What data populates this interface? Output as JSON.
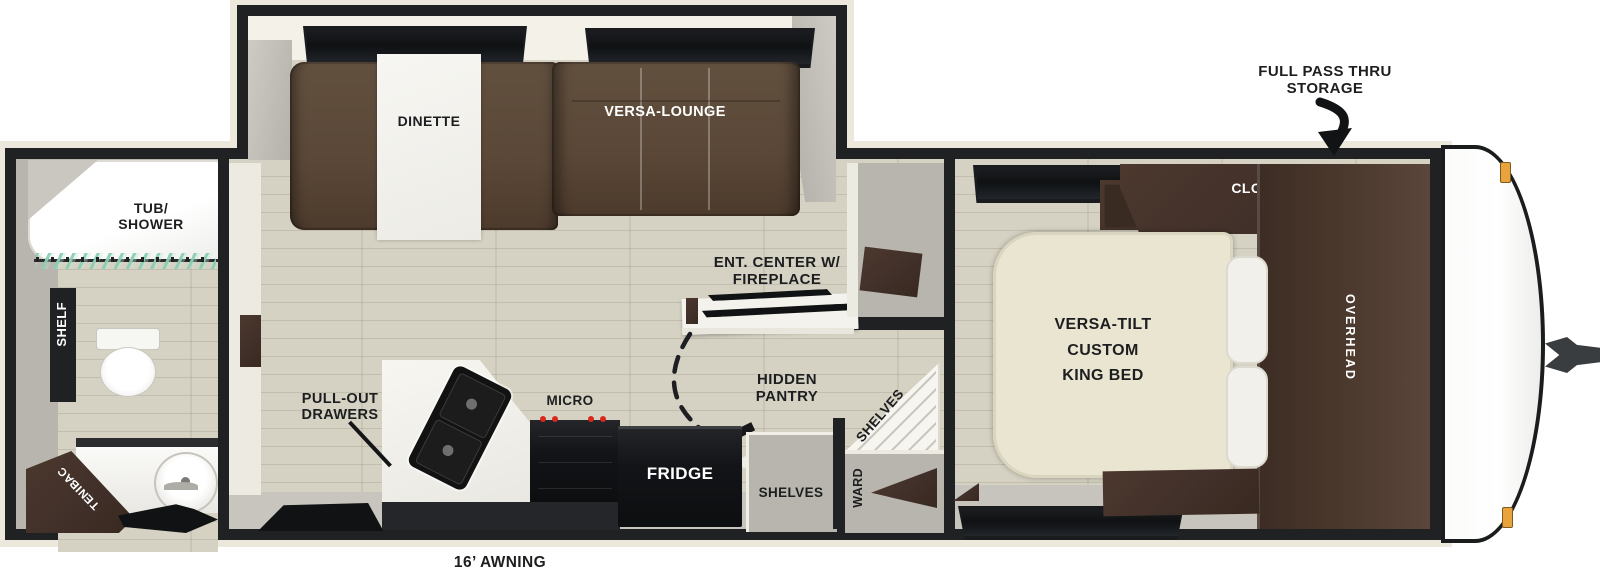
{
  "figure": "rv-travel-trailer-floor-plan",
  "labels": {
    "full_pass_thru_1": "FULL PASS THRU",
    "full_pass_thru_2": "STORAGE",
    "awning": "16’ AWNING",
    "tub_shower_1": "TUB/",
    "tub_shower_2": "SHOWER",
    "shelf": "SHELF",
    "cabinet": "CABINET",
    "dinette": "DINETTE",
    "versa_lounge": "VERSA-LOUNGE",
    "ent_center_1": "ENT. CENTER W/",
    "ent_center_2": "FIREPLACE",
    "hidden_pantry_1": "HIDDEN",
    "hidden_pantry_2": "PANTRY",
    "pantry_shelves": "SHELVES",
    "pull_out_1": "PULL-OUT",
    "pull_out_2": "DRAWERS",
    "micro": "MICRO",
    "fridge": "FRIDGE",
    "shelves": "SHELVES",
    "ward": "WARD",
    "closet": "CLOSET",
    "overhead": "OVERHEAD",
    "bed_1": "VERSA-TILT",
    "bed_2": "CUSTOM",
    "bed_3": "KING BED"
  },
  "colors": {
    "wall": "#1f2123",
    "body_trim": "#ece9dc",
    "floor_wood": "#d6d2c3",
    "wall_grey": "#b7b5ad",
    "sofa_brown": "#5c4738",
    "cabinet_brown": "#44312a",
    "bed_cream": "#e9e5d1",
    "curtain_teal": "#9fd3c2",
    "burner_red": "#d8281e",
    "marker_amber": "#e8a33d"
  }
}
